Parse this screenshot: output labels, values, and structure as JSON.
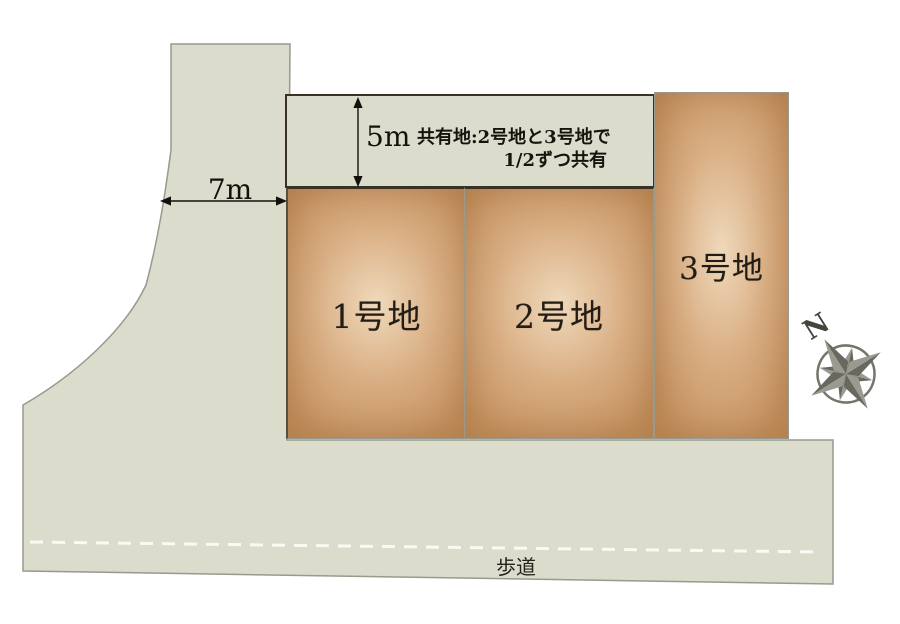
{
  "diagram": {
    "lots": [
      {
        "label": "1号地"
      },
      {
        "label": "2号地"
      },
      {
        "label": "3号地"
      }
    ],
    "dimensions": {
      "road_width": "7m",
      "shared_area_depth": "5m"
    },
    "shared_area_note": {
      "line1": "共有地:2号地と3号地で",
      "line2": "1/2ずつ共有"
    },
    "sidewalk_label": "歩道",
    "compass_north_label": "N",
    "colors": {
      "road_fill": "#dbdccc",
      "road_border": "#99998e",
      "lot_edge": "#c4915f",
      "lot_mid": "#d9ae83",
      "lot_center": "#efd9bb",
      "dark_border": "#3a3126",
      "text": "#211a12",
      "dash": "#fafaf2",
      "compass": "#75756c",
      "compass_dark": "#68685f",
      "compass_light": "#9a9a90"
    }
  }
}
